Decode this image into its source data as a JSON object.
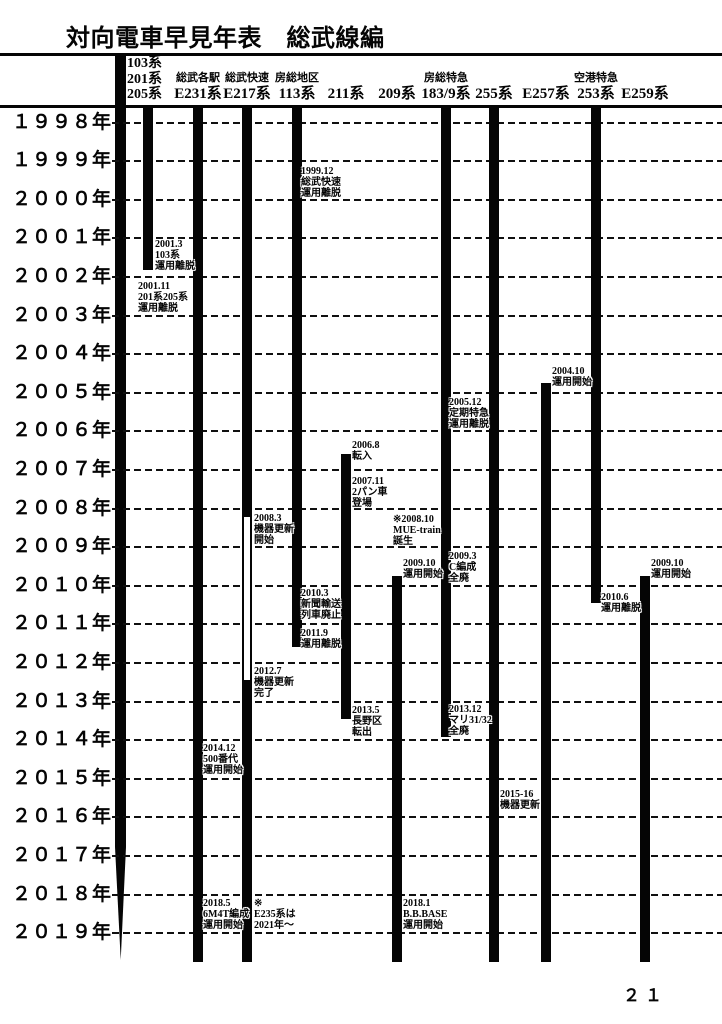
{
  "title": "対向電車早見年表　総武線編",
  "page_number": "２１",
  "chart_data": {
    "type": "timeline",
    "orientation": "vertical",
    "title": "対向電車早見年表　総武線編",
    "axis": {
      "unit": "年",
      "start_year": 1998,
      "end_year": 2019,
      "grid": "dashed-horizontal"
    },
    "years": [
      {
        "value": 1998,
        "label": "１９９８年"
      },
      {
        "value": 1999,
        "label": "１９９９年"
      },
      {
        "value": 2000,
        "label": "２０００年"
      },
      {
        "value": 2001,
        "label": "２００１年"
      },
      {
        "value": 2002,
        "label": "２００２年"
      },
      {
        "value": 2003,
        "label": "２００３年"
      },
      {
        "value": 2004,
        "label": "２００４年"
      },
      {
        "value": 2005,
        "label": "２００５年"
      },
      {
        "value": 2006,
        "label": "２００６年"
      },
      {
        "value": 2007,
        "label": "２００７年"
      },
      {
        "value": 2008,
        "label": "２００８年"
      },
      {
        "value": 2009,
        "label": "２００９年"
      },
      {
        "value": 2010,
        "label": "２０１０年"
      },
      {
        "value": 2011,
        "label": "２０１１年"
      },
      {
        "value": 2012,
        "label": "２０１２年"
      },
      {
        "value": 2013,
        "label": "２０１３年"
      },
      {
        "value": 2014,
        "label": "２０１４年"
      },
      {
        "value": 2015,
        "label": "２０１５年"
      },
      {
        "value": 2016,
        "label": "２０１６年"
      },
      {
        "value": 2017,
        "label": "２０１７年"
      },
      {
        "value": 2018,
        "label": "２０１８年"
      },
      {
        "value": 2019,
        "label": "２０１９年"
      }
    ],
    "series": [
      {
        "id": "103-201-205",
        "name": "103系・201系・205系",
        "header_lines": [
          "103系",
          "201系",
          "205系"
        ],
        "center_x": 148,
        "segments": [
          {
            "start": "top",
            "end": 2001.83,
            "fill": "solid"
          }
        ]
      },
      {
        "id": "e231",
        "name": "総武各駅 E231系",
        "header_small": "総武各駅",
        "header_main": "E231系",
        "center_x": 198,
        "segments": [
          {
            "start": "top",
            "end": "bottom",
            "fill": "solid"
          }
        ]
      },
      {
        "id": "e217",
        "name": "総武快速 E217系",
        "header_small": "総武快速",
        "header_main": "E217系",
        "center_x": 247,
        "segments": [
          {
            "start": "top",
            "end": 2008.17,
            "fill": "solid"
          },
          {
            "start": 2008.17,
            "end": 2012.5,
            "fill": "hollow"
          },
          {
            "start": 2012.5,
            "end": "bottom",
            "fill": "solid"
          }
        ]
      },
      {
        "id": "113",
        "name": "房総地区 113系",
        "header_small": "房総地区",
        "header_main": "113系",
        "center_x": 297,
        "segments": [
          {
            "start": "top",
            "end": 2011.6,
            "fill": "solid"
          }
        ]
      },
      {
        "id": "211",
        "name": "211系",
        "header_main": "211系",
        "center_x": 346,
        "segments": [
          {
            "start": 2006.58,
            "end": 2013.45,
            "fill": "solid"
          }
        ]
      },
      {
        "id": "209",
        "name": "209系",
        "header_main": "209系",
        "center_x": 397,
        "segments": [
          {
            "start": 2009.75,
            "end": "bottom",
            "fill": "solid"
          }
        ]
      },
      {
        "id": "183-9",
        "name": "房総特急 183/9系",
        "header_small": "房総特急",
        "header_main": "183/9系",
        "center_x": 446,
        "segments": [
          {
            "start": "top",
            "end": 2013.92,
            "fill": "solid"
          }
        ]
      },
      {
        "id": "255",
        "name": "255系",
        "header_main": "255系",
        "center_x": 494,
        "segments": [
          {
            "start": "top",
            "end": "bottom",
            "fill": "solid"
          }
        ]
      },
      {
        "id": "e257",
        "name": "E257系",
        "header_main": "E257系",
        "center_x": 546,
        "segments": [
          {
            "start": 2004.75,
            "end": "bottom",
            "fill": "solid"
          }
        ]
      },
      {
        "id": "253",
        "name": "空港特急 253系",
        "header_small": "空港特急",
        "header_main": "253系",
        "center_x": 596,
        "segments": [
          {
            "start": "top",
            "end": 2010.45,
            "fill": "solid"
          }
        ]
      },
      {
        "id": "e259",
        "name": "E259系",
        "header_main": "E259系",
        "center_x": 645,
        "segments": [
          {
            "start": 2009.75,
            "end": "bottom",
            "fill": "solid"
          }
        ]
      }
    ],
    "annotations": [
      {
        "x": 301,
        "y": 166,
        "lines": [
          "1999.12",
          "総武快速",
          "運用離脱"
        ]
      },
      {
        "x": 155,
        "y": 239,
        "lines": [
          "2001.3",
          "103系",
          "運用離脱"
        ]
      },
      {
        "x": 138,
        "y": 281,
        "lines": [
          "2001.11",
          "201系205系",
          "運用離脱"
        ]
      },
      {
        "x": 552,
        "y": 366,
        "lines": [
          "2004.10",
          "運用開始"
        ]
      },
      {
        "x": 449,
        "y": 397,
        "lines": [
          "2005.12",
          "定期特急",
          "運用離脱"
        ]
      },
      {
        "x": 352,
        "y": 440,
        "lines": [
          "2006.8",
          "転入"
        ]
      },
      {
        "x": 352,
        "y": 476,
        "lines": [
          "2007.11",
          "2パン車",
          "登場"
        ]
      },
      {
        "x": 254,
        "y": 513,
        "lines": [
          "2008.3",
          "機器更新",
          "開始"
        ]
      },
      {
        "x": 393,
        "y": 514,
        "lines": [
          "※2008.10",
          "MUE-train",
          "誕生"
        ]
      },
      {
        "x": 449,
        "y": 551,
        "lines": [
          "2009.3",
          "C編成",
          "全廃"
        ]
      },
      {
        "x": 403,
        "y": 558,
        "lines": [
          "2009.10",
          "運用開始"
        ]
      },
      {
        "x": 651,
        "y": 558,
        "lines": [
          "2009.10",
          "運用開始"
        ]
      },
      {
        "x": 301,
        "y": 588,
        "lines": [
          "2010.3",
          "新聞輸送",
          "列車廃止"
        ]
      },
      {
        "x": 601,
        "y": 592,
        "lines": [
          "2010.6",
          "運用離脱"
        ]
      },
      {
        "x": 301,
        "y": 628,
        "lines": [
          "2011.9",
          "運用離脱"
        ]
      },
      {
        "x": 254,
        "y": 666,
        "lines": [
          "2012.7",
          "機器更新",
          "完了"
        ]
      },
      {
        "x": 352,
        "y": 705,
        "lines": [
          "2013.5",
          "長野区",
          "転出"
        ]
      },
      {
        "x": 449,
        "y": 704,
        "lines": [
          "2013.12",
          "マリ31/32",
          "全廃"
        ]
      },
      {
        "x": 203,
        "y": 743,
        "lines": [
          "2014.12",
          "500番代",
          "運用開始"
        ]
      },
      {
        "x": 500,
        "y": 789,
        "lines": [
          "2015-16",
          "機器更新"
        ]
      },
      {
        "x": 403,
        "y": 898,
        "lines": [
          "2018.1",
          "B.B.BASE",
          "運用開始"
        ]
      },
      {
        "x": 203,
        "y": 898,
        "lines": [
          "2018.5",
          "6M4T編成",
          "運用開始"
        ]
      },
      {
        "x": 254,
        "y": 898,
        "lines": [
          "※",
          "E235系は",
          "2021年～"
        ]
      }
    ]
  }
}
